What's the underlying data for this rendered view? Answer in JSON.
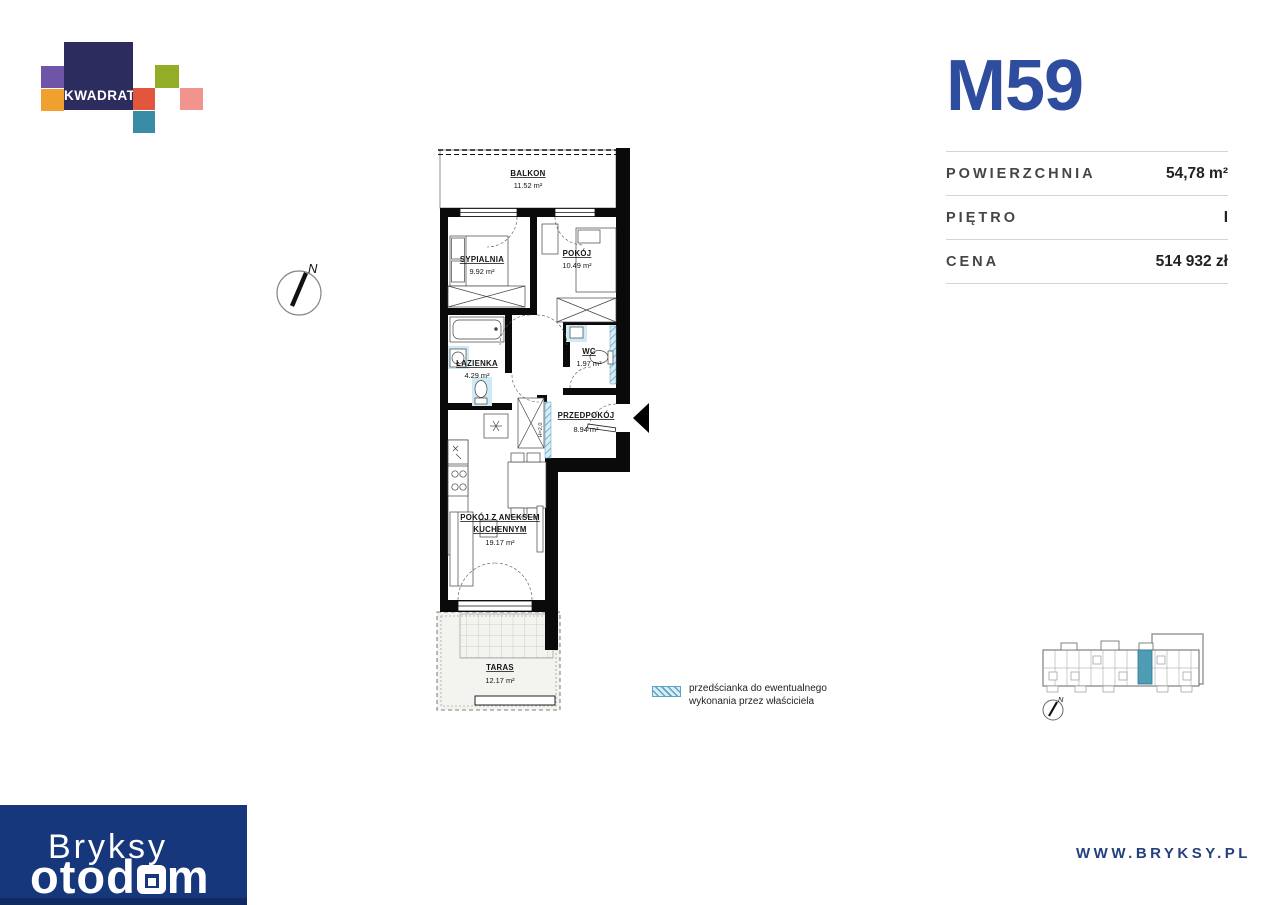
{
  "branding": {
    "developer_logo": "KWADRAT",
    "agency_name": "Bryksy",
    "watermark_part1": "otod",
    "watermark_part2": "m",
    "website": "WWW.BRYKSY.PL"
  },
  "unit": {
    "id": "M59",
    "details": {
      "rows": [
        {
          "label": "POWIERZCHNIA",
          "value": "54,78 m²"
        },
        {
          "label": "PIĘTRO",
          "value": "I"
        },
        {
          "label": "CENA",
          "value": "514 932 zł"
        }
      ]
    }
  },
  "floor_plan": {
    "compass_label": "N",
    "wall_height_note": "H=2,0",
    "rooms": {
      "balkon": {
        "name": "BALKON",
        "area": "11.52 m²"
      },
      "sypialnia": {
        "name": "SYPIALNIA",
        "area": "9.92 m²"
      },
      "pokoj": {
        "name": "POKÓJ",
        "area": "10.49 m²"
      },
      "lazienka": {
        "name": "ŁAZIENKA",
        "area": "4.29 m²"
      },
      "wc": {
        "name": "WC",
        "area": "1.97 m²"
      },
      "przedpokoj": {
        "name": "PRZEDPOKÓJ",
        "area": "8.94 m²"
      },
      "pokoj_z_aneksem": {
        "name_line1": "POKÓJ Z ANEKSEM",
        "name_line2": "KUCHENNYM",
        "area": "19.17 m²"
      },
      "taras": {
        "name": "TARAS",
        "area": "12.17 m²"
      }
    },
    "legend": {
      "line1": "przedścianka do ewentualnego",
      "line2": "wykonania przez właściciela"
    }
  },
  "site_plan": {
    "compass_label": "N"
  },
  "colors": {
    "accent_blue": "#2e4d9e",
    "footer_blue": "#17377d",
    "highlight_teal": "#4f9cb5",
    "fixture_blue": "#cfe9f5"
  }
}
